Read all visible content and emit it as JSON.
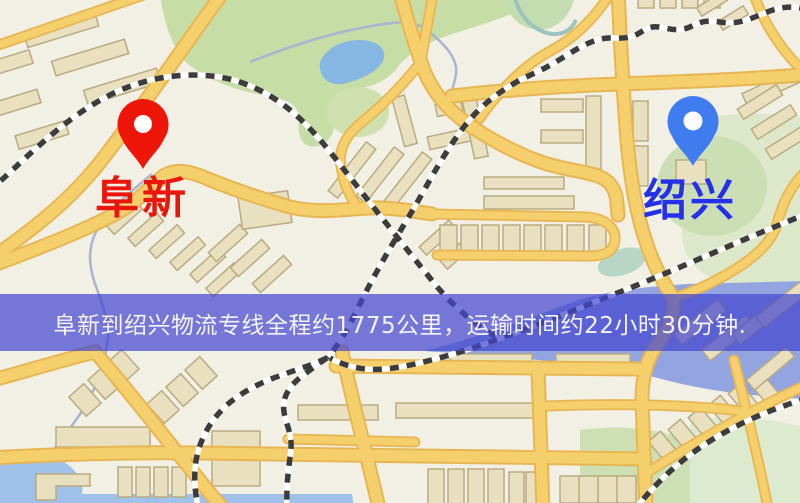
{
  "map": {
    "type": "stylized-street-map",
    "origin": {
      "label": "阜新",
      "label_color": "#e9160b",
      "pin_color": "#ee1608",
      "pin_kind": "red-map-marker"
    },
    "destination": {
      "label": "绍兴",
      "label_color": "#2531e9",
      "pin_color": "#3f7cf0",
      "pin_kind": "blue-map-marker"
    },
    "banner": {
      "text": "阜新到绍兴物流专线全程约1775公里，运输时间约22小时30分钟.",
      "distance_km": "1775",
      "duration": "22小时30分钟",
      "bg_color": "#4446ce",
      "text_color": "#f4f3ff"
    },
    "palette": {
      "background": "#f2efe4",
      "road_fill": "#f6cf6d",
      "road_border": "#e7b652",
      "building_fill": "#e9e0c0",
      "building_border": "#b9ab80",
      "park": "#c7dda6",
      "park_light": "#dde8cb",
      "water": "#93a5e0",
      "water_light": "#9fc0e8",
      "pond": "#85b7e2",
      "rail_dark": "#3c3c3c",
      "rail_light": "#ffffff",
      "stream": "#a9b4cf"
    }
  }
}
